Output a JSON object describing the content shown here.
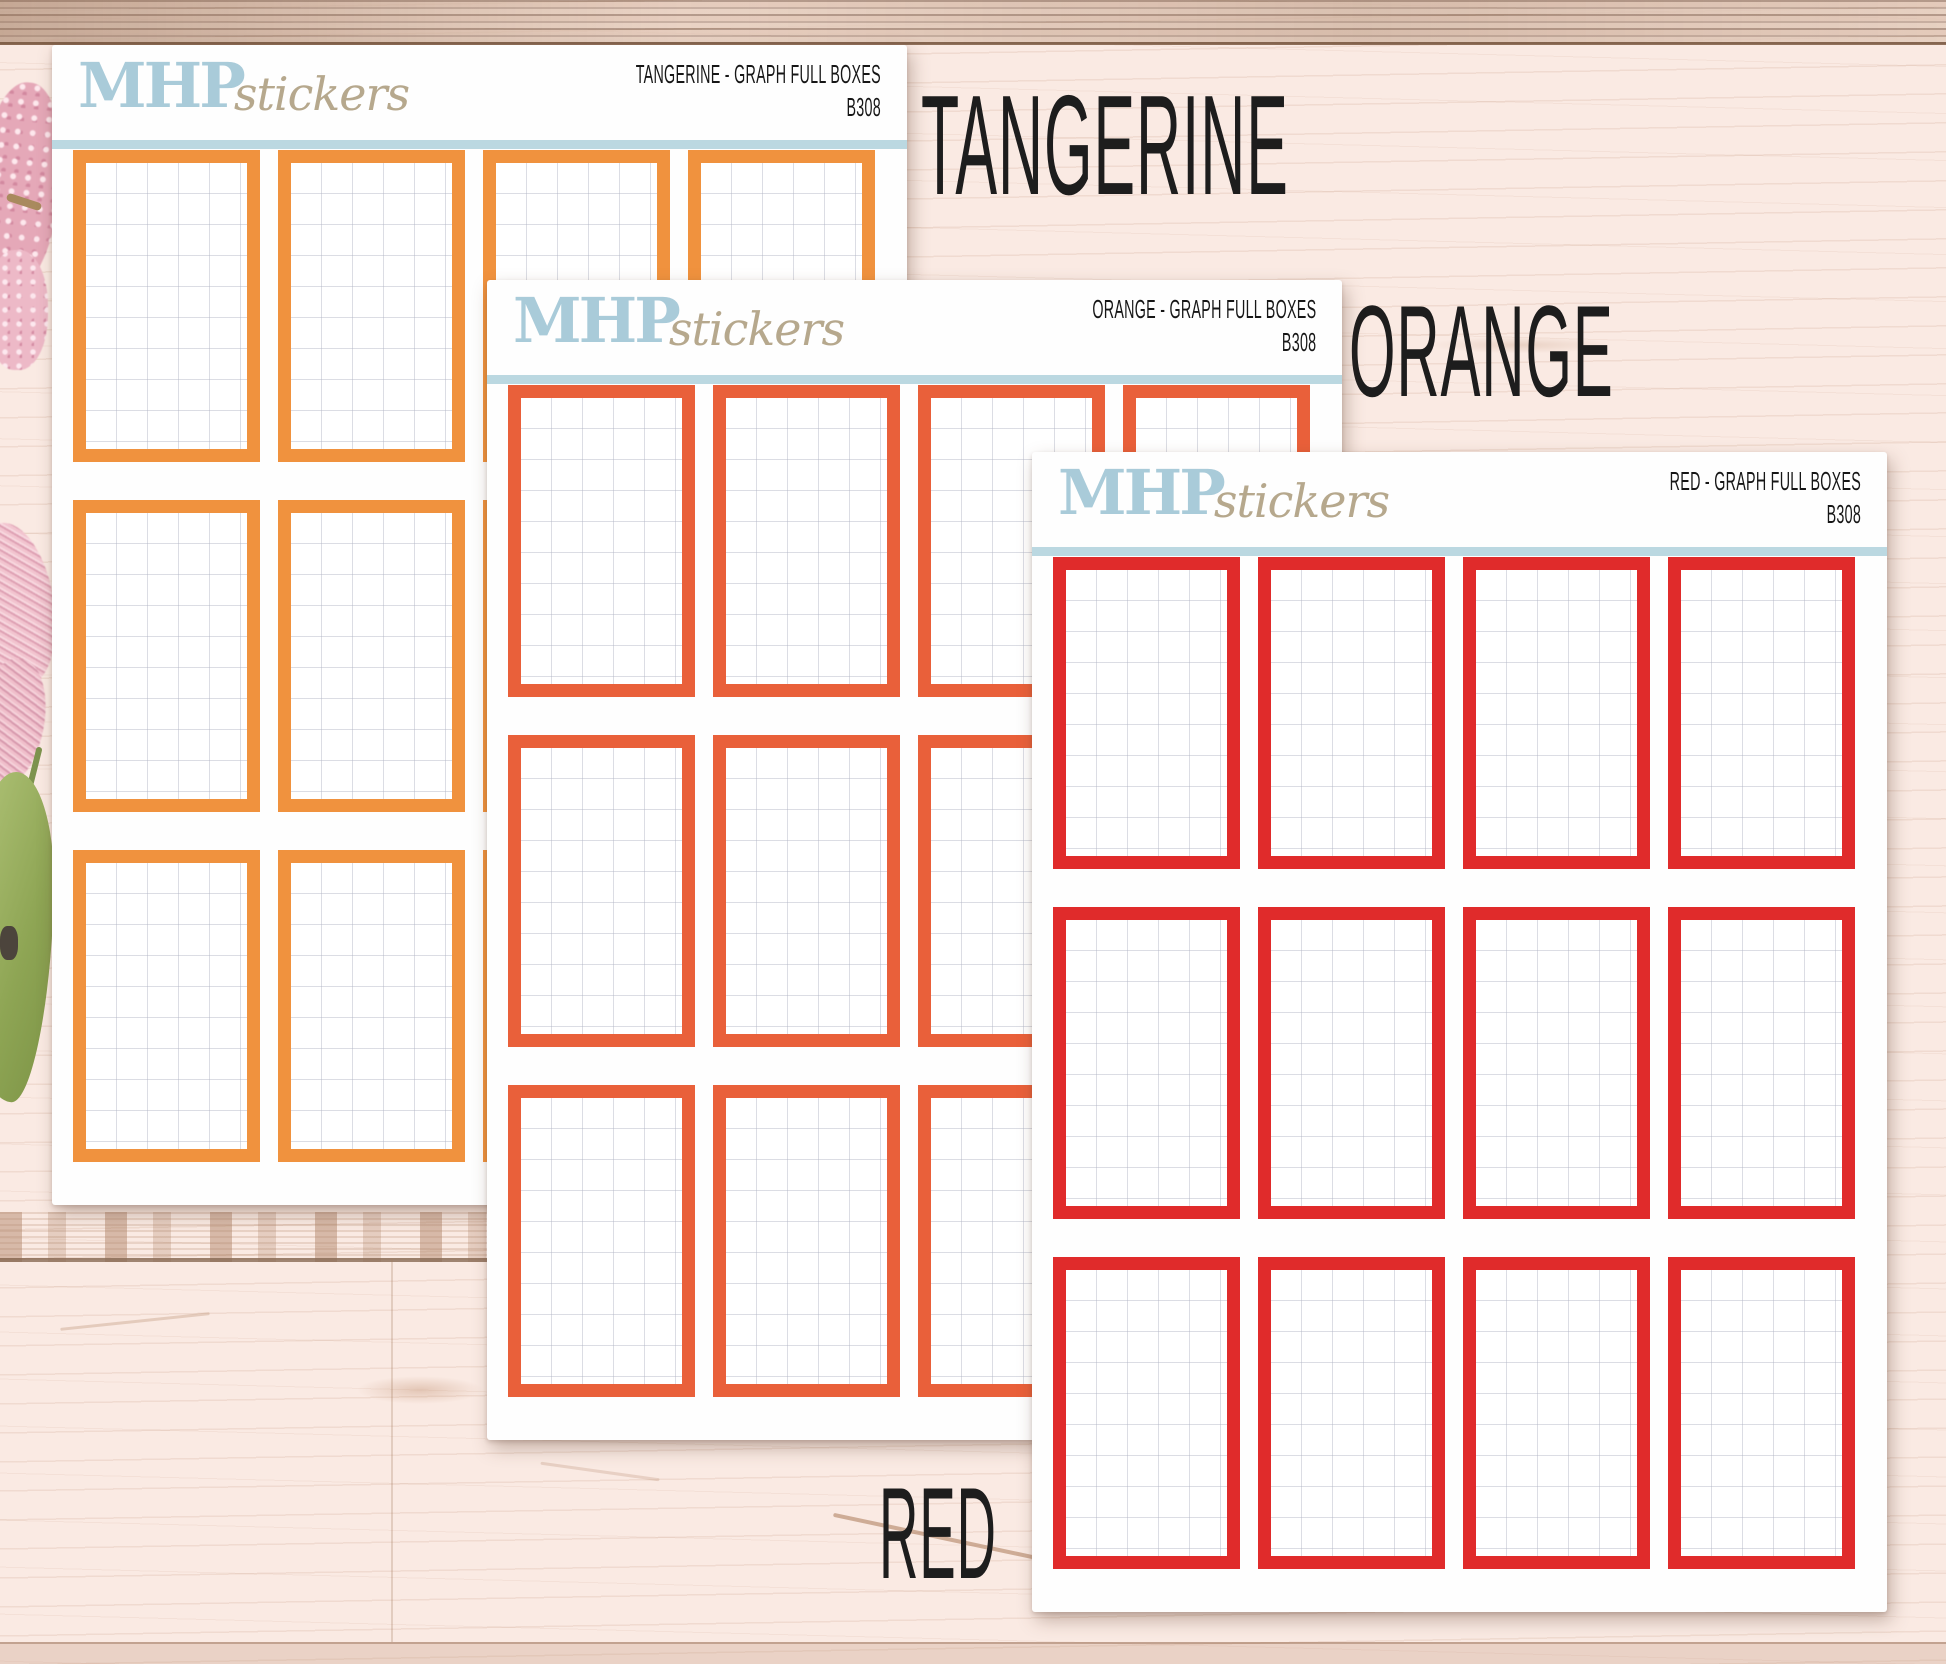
{
  "photo": {
    "brand": {
      "name_bold": "MHP",
      "name_script": "stickers"
    },
    "sheets": [
      {
        "key": "tangerine",
        "title": "TANGERINE - GRAPH FULL BOXES",
        "code": "B308",
        "label": "TANGERINE",
        "box_color": "#F0923E",
        "columns": 4,
        "rows": 3,
        "box_count": 12
      },
      {
        "key": "orange",
        "title": "ORANGE - GRAPH FULL BOXES",
        "code": "B308",
        "label": "ORANGE",
        "box_color": "#E9603A",
        "columns": 4,
        "rows": 3,
        "box_count": 12
      },
      {
        "key": "red",
        "title": "RED - GRAPH FULL BOXES",
        "code": "B308",
        "label": "RED",
        "box_color": "#E02B2B",
        "columns": 4,
        "rows": 3,
        "box_count": 12
      }
    ],
    "colors": {
      "logo_blue": "#A9CBD9",
      "logo_tan": "#B6A88D",
      "divider_blue": "#BBD8E1",
      "graph_grid_line": "#DDDFE6",
      "label_ink": "#1D1D1D",
      "wood_base": "#FAEAE3",
      "sheet_white": "#FEFEFE"
    }
  }
}
